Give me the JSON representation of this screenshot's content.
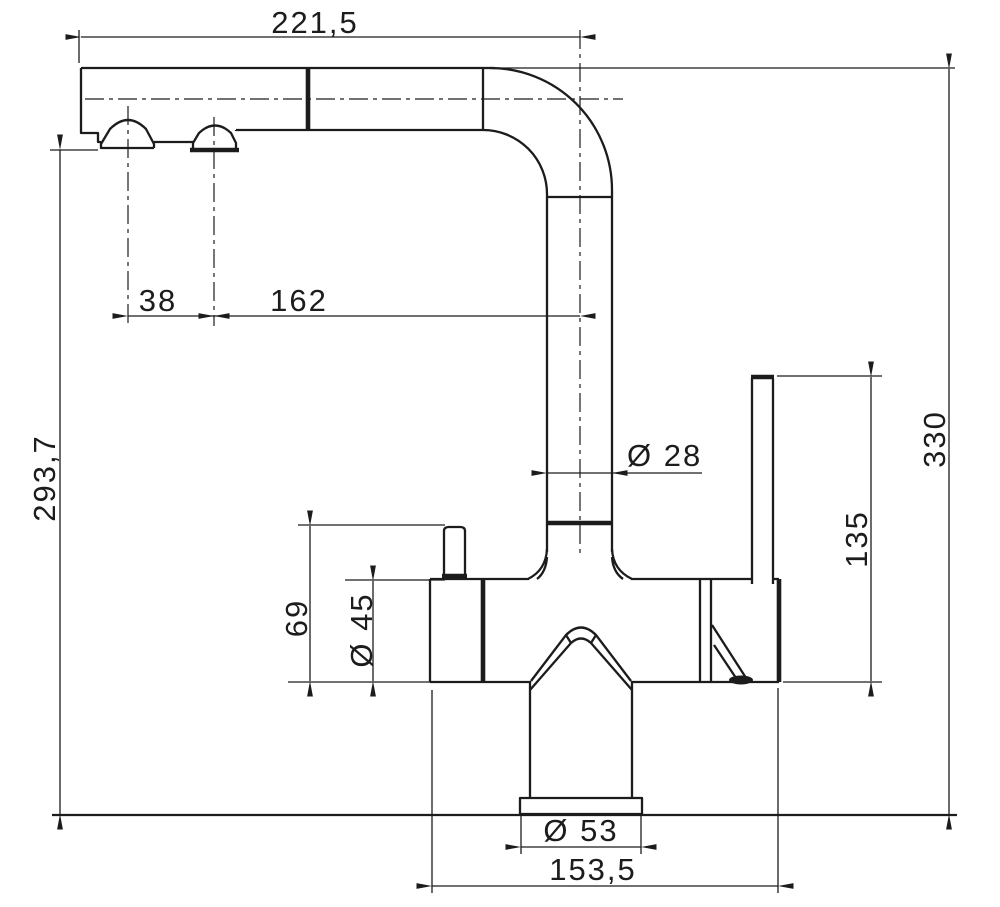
{
  "drawing": {
    "type": "technical-dimension-drawing",
    "subject": "kitchen-faucet-side-view",
    "units": "mm",
    "colors": {
      "line": "#1c1c1c",
      "background": "#ffffff"
    },
    "dimensions": {
      "spout_reach": "221,5",
      "nozzle_spacing": "38",
      "nozzle_to_riser_axis": "162",
      "outlet_height": "293,7",
      "overall_height": "330",
      "riser_diameter": "Ø 28",
      "lever_height": "135",
      "knob_to_base_height": "69",
      "body_diameter": "Ø 45",
      "base_diameter": "Ø 53",
      "body_to_lever_span": "153,5"
    }
  }
}
